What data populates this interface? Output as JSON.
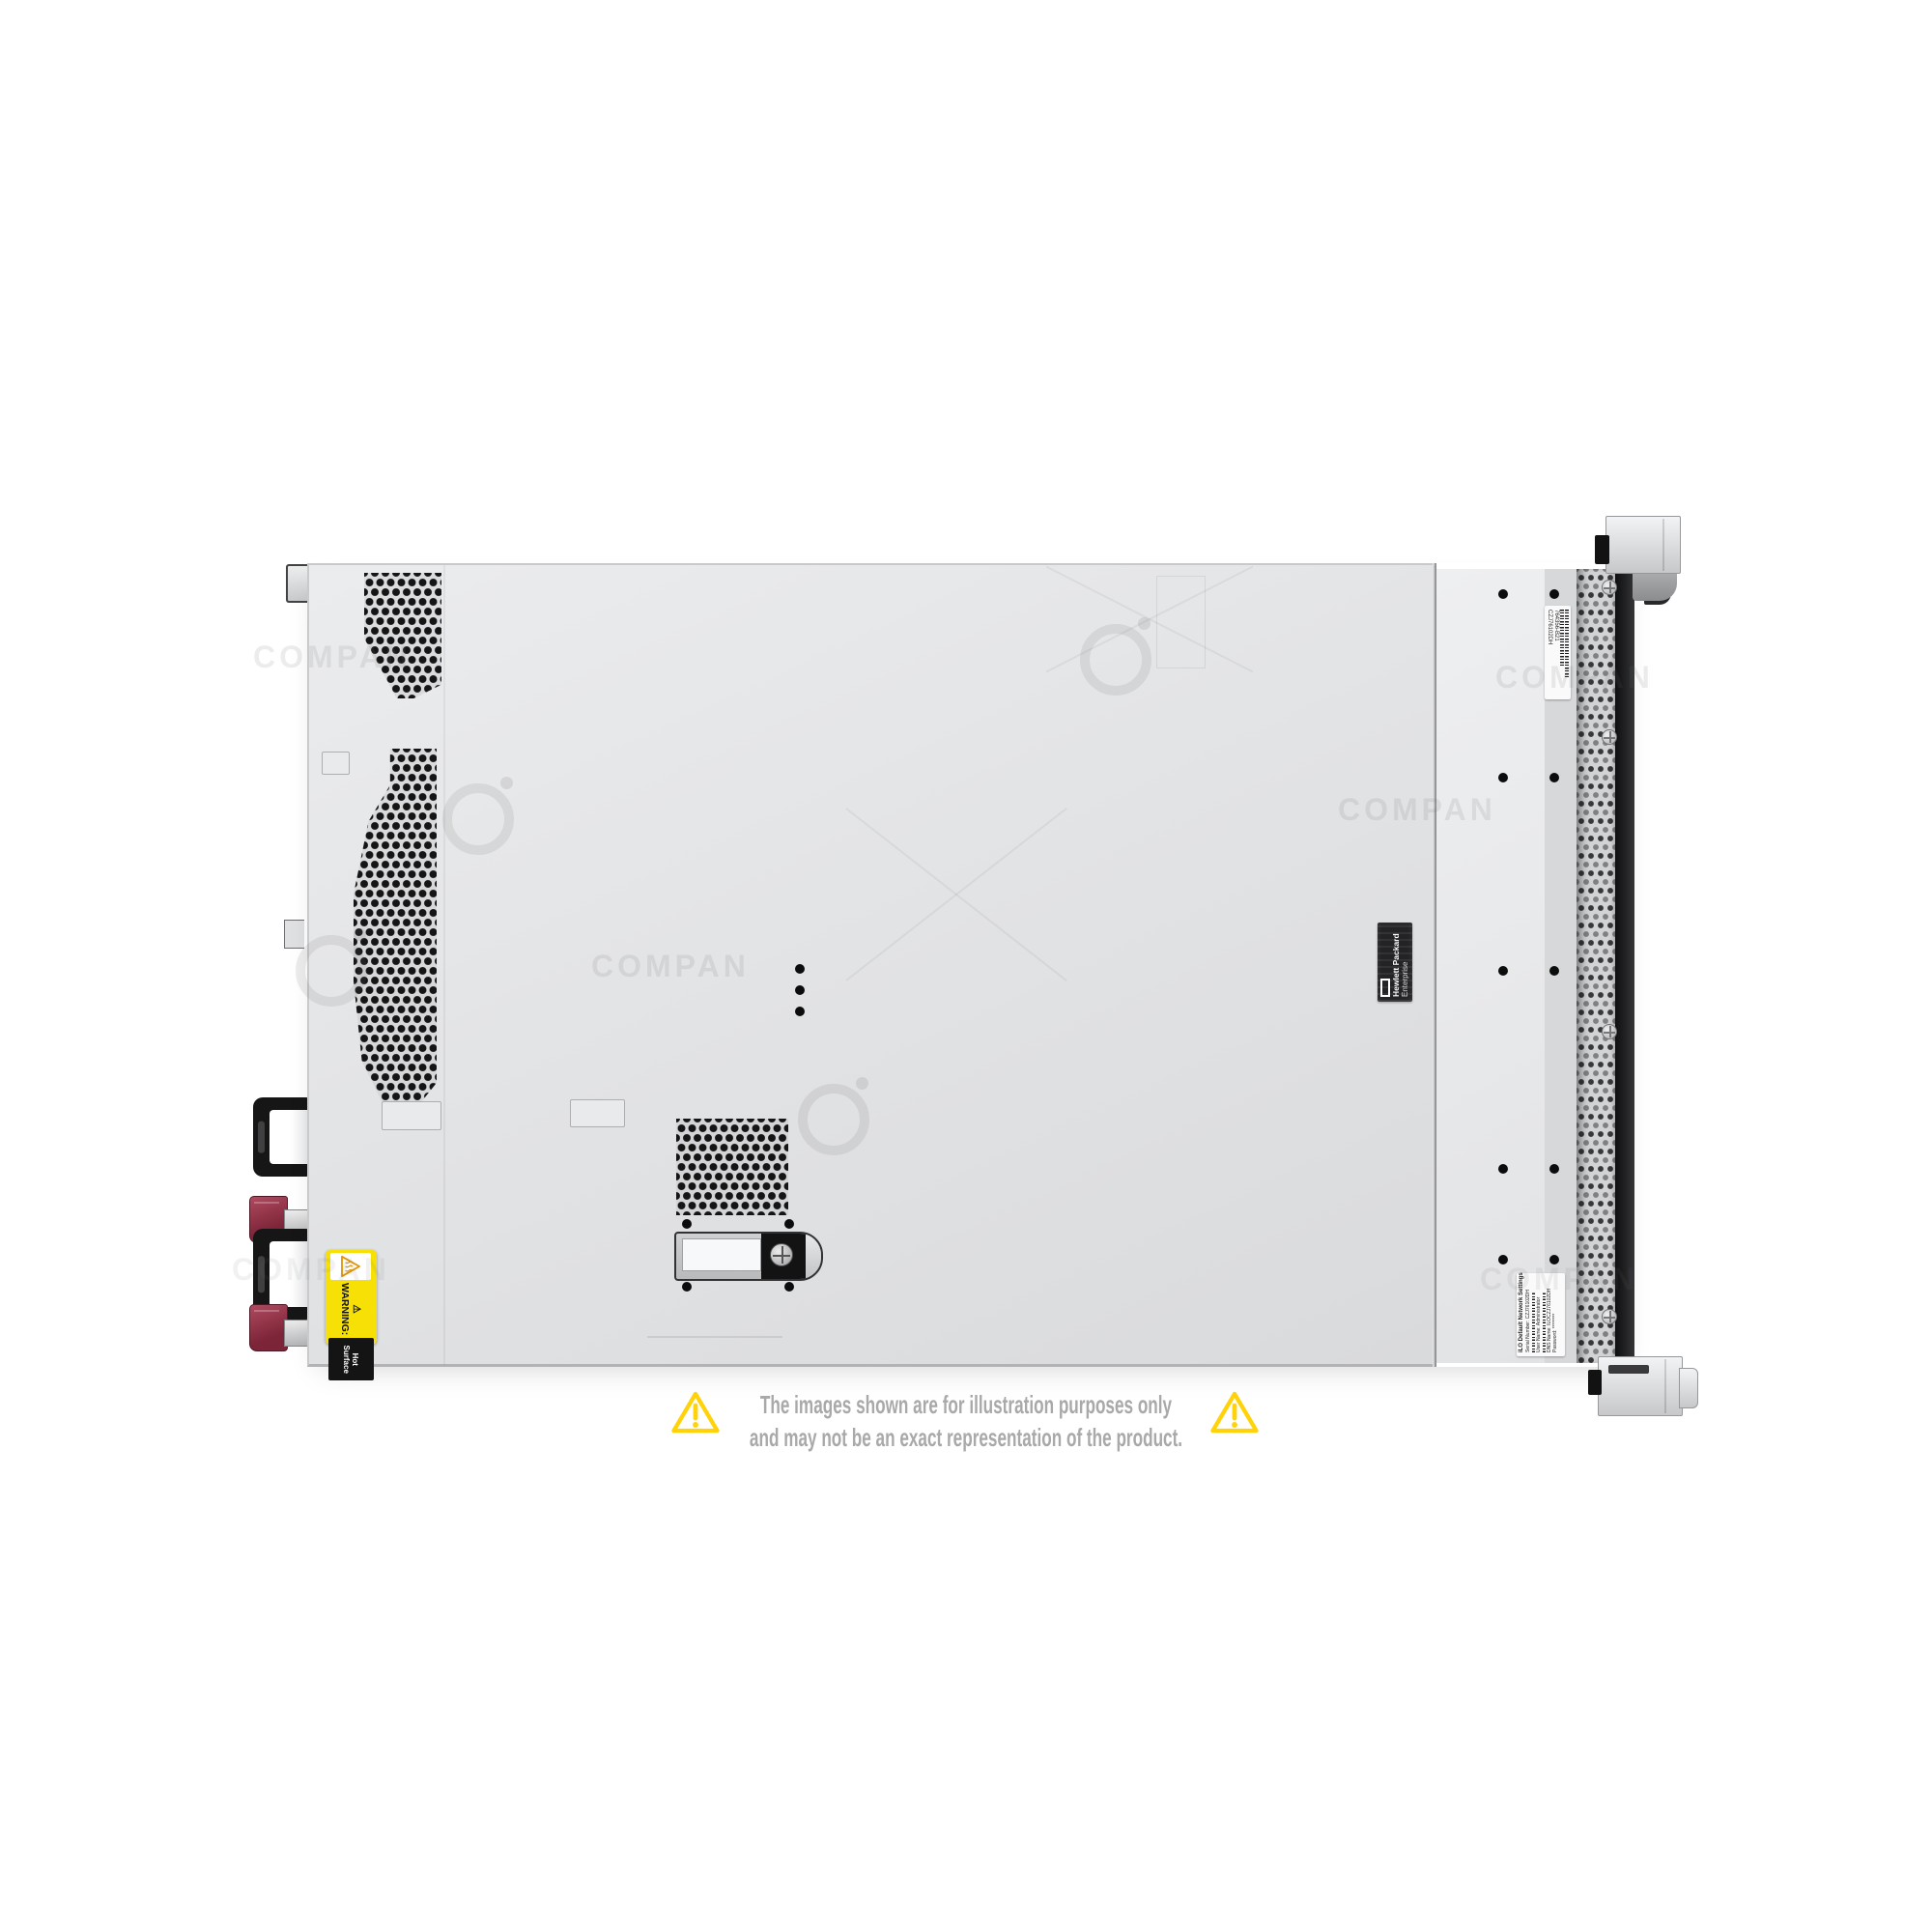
{
  "meta": {
    "description": "Product photo of an HPE 1U rack server shown from the top, with reseller watermark and disclaimer"
  },
  "watermark": {
    "text": "COMPAN",
    "logo_name": "ci-circle-logo"
  },
  "disclaimer": {
    "line1": "The images shown are for illustration purposes only",
    "line2": "and may not be an exact representation of the product.",
    "icon": "warning-triangle-icon",
    "text_color": "#A9A9A9",
    "icon_color": "#FFD20A"
  },
  "server": {
    "view": "top",
    "labels": {
      "hot_surface": {
        "warning_text": "⚠ WARNING:",
        "surface_text": "Hot Surface",
        "bg": "#F6E005"
      },
      "brand": {
        "line1": "Hewlett Packard",
        "line2": "Enterprise"
      },
      "service_tag": {
        "serial": "CZJ76102DH",
        "part_number": "764356-B21"
      },
      "ilo": {
        "title": "iLO Default Network Settings",
        "lines": [
          "Serial Number: CZJ76102DH",
          "User Name: Administrator",
          "DNS Name: ILOCZJ76102DH",
          "Password: ********"
        ]
      }
    },
    "colors": {
      "chassis": "#E2E3E5",
      "front_edge_black": "#141415",
      "handle_black": "#151516",
      "tab_maroon": "#8E3247"
    }
  }
}
